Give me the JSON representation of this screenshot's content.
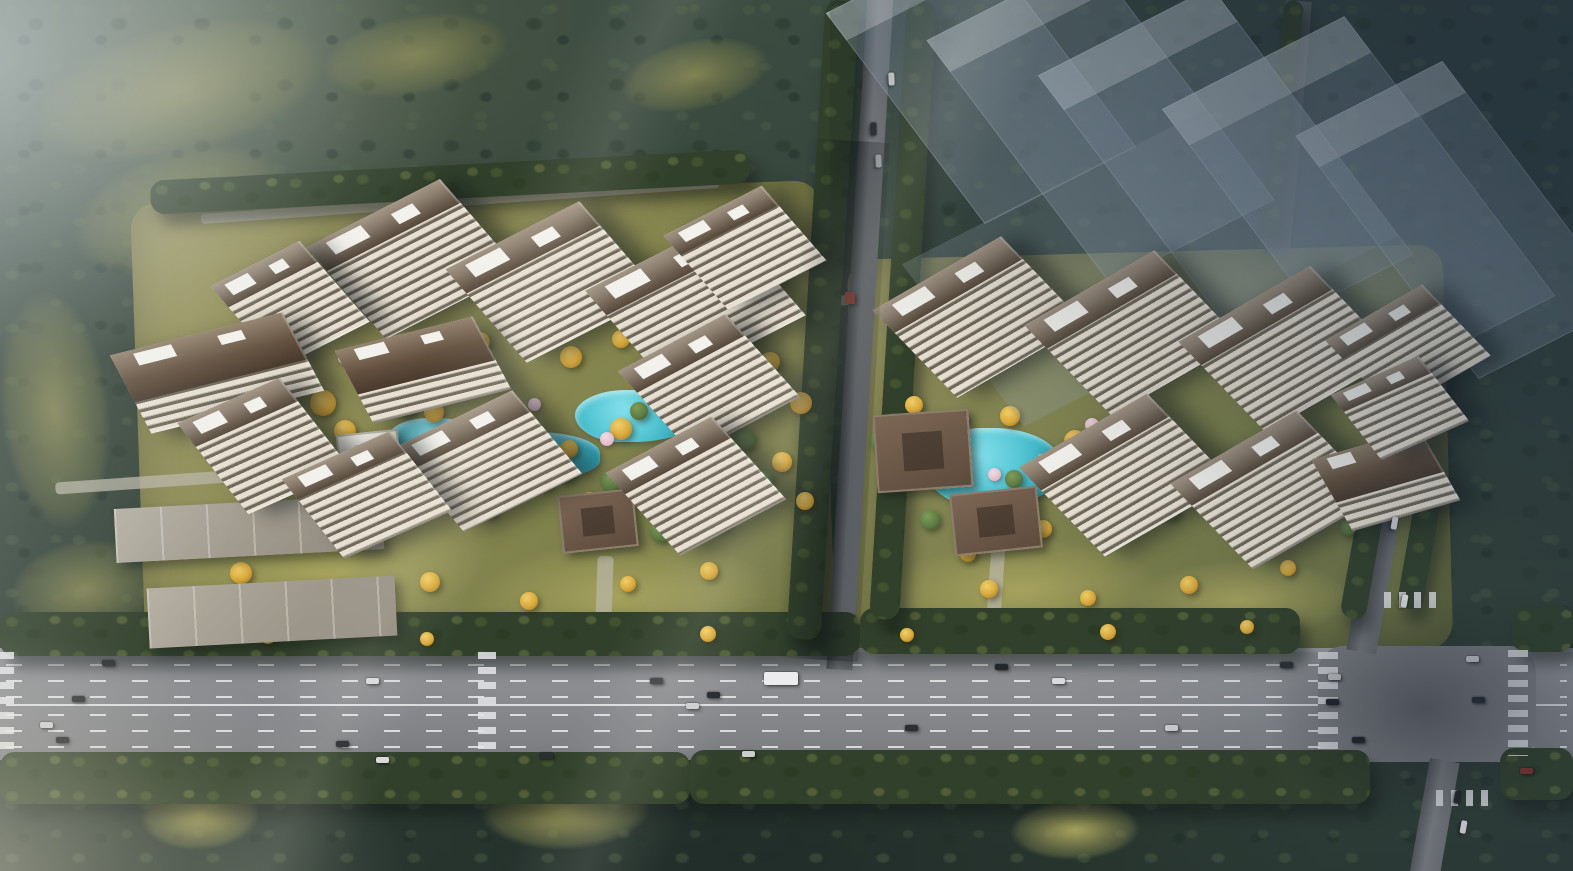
{
  "meta": {
    "scene_type": "aerial architectural rendering of a residential development",
    "width": 1573,
    "height": 871
  },
  "palette": {
    "field_olive": "#7d7f4f",
    "lawn_gold": "#a6a25d",
    "gold_tree": "#d9a93c",
    "green_tree": "#5d7a44",
    "blossom": "#e4becb",
    "pool": "#45bccd",
    "facade_light": "#e7e0d2",
    "facade_dark": "#6f685a",
    "roof_brown": "#64513f",
    "white_roof": "#f2f1ec"
  },
  "terrain": {
    "fields": [
      {
        "x": 30,
        "y": 25,
        "w": 300,
        "h": 130,
        "r": -14
      },
      {
        "x": 70,
        "y": 150,
        "w": 220,
        "h": 120,
        "r": -18
      },
      {
        "x": 320,
        "y": 15,
        "w": 190,
        "h": 80,
        "r": -10
      },
      {
        "x": 0,
        "y": 290,
        "w": 110,
        "h": 240,
        "r": -6
      },
      {
        "x": 10,
        "y": 540,
        "w": 150,
        "h": 100,
        "r": -8
      },
      {
        "x": 620,
        "y": 40,
        "w": 150,
        "h": 70,
        "r": -12
      }
    ],
    "lawns": [
      {
        "x": 180,
        "y": 520,
        "w": 300,
        "h": 110,
        "r": -4
      },
      {
        "x": 470,
        "y": 540,
        "w": 300,
        "h": 110,
        "r": -3
      },
      {
        "x": 880,
        "y": 540,
        "w": 280,
        "h": 100,
        "r": -3
      },
      {
        "x": 1130,
        "y": 560,
        "w": 220,
        "h": 80,
        "r": -2
      },
      {
        "x": 480,
        "y": 770,
        "w": 170,
        "h": 80,
        "r": -2
      },
      {
        "x": 140,
        "y": 780,
        "w": 120,
        "h": 70,
        "r": -3
      },
      {
        "x": 1010,
        "y": 800,
        "w": 130,
        "h": 60,
        "r": -2
      }
    ],
    "paths": [
      {
        "x": 55,
        "y": 470,
        "w": 360,
        "h": 12,
        "r": -4
      },
      {
        "x": 596,
        "y": 556,
        "w": 16,
        "h": 96,
        "r": 2
      },
      {
        "x": 988,
        "y": 545,
        "w": 14,
        "h": 100,
        "r": 4
      },
      {
        "x": 808,
        "y": 296,
        "w": 52,
        "h": 10,
        "r": -4
      },
      {
        "x": 200,
        "y": 196,
        "w": 520,
        "h": 10,
        "r": -4
      }
    ]
  },
  "vegetation": {
    "tree_rows": [
      {
        "x": 0,
        "y": 612,
        "w": 860,
        "h": 44,
        "r": 0
      },
      {
        "x": 860,
        "y": 608,
        "w": 440,
        "h": 46,
        "r": 0
      },
      {
        "x": 1512,
        "y": 606,
        "w": 61,
        "h": 46,
        "r": 0
      },
      {
        "x": 0,
        "y": 752,
        "w": 690,
        "h": 52,
        "r": 0
      },
      {
        "x": 690,
        "y": 750,
        "w": 680,
        "h": 54,
        "r": 0
      },
      {
        "x": 1500,
        "y": 748,
        "w": 73,
        "h": 52,
        "r": 0
      },
      {
        "x": 806,
        "y": 0,
        "w": 34,
        "h": 640,
        "r": 3.5
      },
      {
        "x": 888,
        "y": 0,
        "w": 30,
        "h": 620,
        "r": 3.5
      },
      {
        "x": 1352,
        "y": 470,
        "w": 26,
        "h": 150,
        "r": 10
      },
      {
        "x": 1408,
        "y": 470,
        "w": 26,
        "h": 140,
        "r": 10
      },
      {
        "x": 150,
        "y": 165,
        "w": 600,
        "h": 34,
        "r": -3
      },
      {
        "x": 1272,
        "y": 0,
        "w": 20,
        "h": 240,
        "r": 6
      }
    ],
    "golden_trees": [
      [
        310,
        390,
        26
      ],
      [
        334,
        420,
        22
      ],
      [
        368,
        455,
        24
      ],
      [
        298,
        470,
        20
      ],
      [
        424,
        402,
        20
      ],
      [
        450,
        418,
        18
      ],
      [
        505,
        452,
        24
      ],
      [
        534,
        470,
        20
      ],
      [
        560,
        440,
        18
      ],
      [
        610,
        418,
        22
      ],
      [
        640,
        450,
        26
      ],
      [
        680,
        430,
        20
      ],
      [
        700,
        462,
        24
      ],
      [
        722,
        408,
        18
      ],
      [
        660,
        482,
        22
      ],
      [
        580,
        492,
        20
      ],
      [
        480,
        500,
        18
      ],
      [
        410,
        492,
        16
      ],
      [
        350,
        498,
        18
      ],
      [
        470,
        332,
        20
      ],
      [
        560,
        346,
        22
      ],
      [
        612,
        330,
        18
      ],
      [
        760,
        352,
        20
      ],
      [
        790,
        392,
        22
      ],
      [
        772,
        452,
        20
      ],
      [
        796,
        492,
        18
      ],
      [
        230,
        562,
        22
      ],
      [
        300,
        586,
        18
      ],
      [
        420,
        572,
        20
      ],
      [
        520,
        592,
        18
      ],
      [
        620,
        576,
        16
      ],
      [
        700,
        562,
        18
      ],
      [
        905,
        396,
        18
      ],
      [
        1000,
        406,
        20
      ],
      [
        1064,
        430,
        22
      ],
      [
        1090,
        470,
        26
      ],
      [
        1114,
        500,
        22
      ],
      [
        1150,
        470,
        20
      ],
      [
        1180,
        440,
        18
      ],
      [
        1210,
        470,
        16
      ],
      [
        1240,
        500,
        18
      ],
      [
        1034,
        520,
        18
      ],
      [
        960,
        546,
        16
      ],
      [
        1264,
        430,
        16
      ],
      [
        980,
        580,
        18
      ],
      [
        1080,
        590,
        16
      ],
      [
        1180,
        576,
        18
      ],
      [
        1280,
        560,
        16
      ],
      [
        260,
        628,
        16
      ],
      [
        420,
        632,
        14
      ],
      [
        700,
        626,
        16
      ],
      [
        900,
        628,
        14
      ],
      [
        1100,
        624,
        16
      ],
      [
        1240,
        620,
        14
      ]
    ],
    "green_trees": [
      [
        395,
        395,
        22
      ],
      [
        440,
        440,
        20
      ],
      [
        475,
        470,
        18
      ],
      [
        520,
        420,
        16
      ],
      [
        555,
        462,
        20
      ],
      [
        600,
        470,
        22
      ],
      [
        630,
        402,
        18
      ],
      [
        700,
        390,
        16
      ],
      [
        735,
        430,
        20
      ],
      [
        755,
        470,
        18
      ],
      [
        870,
        430,
        22
      ],
      [
        920,
        510,
        20
      ],
      [
        1005,
        470,
        18
      ],
      [
        1060,
        440,
        16
      ],
      [
        1160,
        500,
        20
      ],
      [
        1230,
        450,
        18
      ],
      [
        260,
        430,
        20
      ],
      [
        280,
        500,
        18
      ],
      [
        650,
        520,
        22
      ],
      [
        710,
        510,
        20
      ],
      [
        1300,
        470,
        18
      ],
      [
        1340,
        520,
        16
      ]
    ],
    "blossom_trees": [
      [
        435,
        432,
        16
      ],
      [
        462,
        452,
        14
      ],
      [
        528,
        398,
        13
      ],
      [
        600,
        432,
        14
      ],
      [
        955,
        412,
        14
      ],
      [
        988,
        468,
        13
      ],
      [
        1085,
        418,
        14
      ],
      [
        1142,
        432,
        12
      ],
      [
        338,
        352,
        12
      ]
    ]
  },
  "water": {
    "ponds": [
      {
        "x": 388,
        "y": 418,
        "w": 95,
        "h": 42
      },
      {
        "x": 470,
        "y": 432,
        "w": 130,
        "h": 48
      },
      {
        "x": 575,
        "y": 390,
        "w": 120,
        "h": 52
      },
      {
        "x": 668,
        "y": 388,
        "w": 55,
        "h": 36
      },
      {
        "x": 425,
        "y": 466,
        "w": 60,
        "h": 26
      },
      {
        "x": 925,
        "y": 428,
        "w": 135,
        "h": 78
      },
      {
        "x": 1048,
        "y": 470,
        "w": 60,
        "h": 30
      },
      {
        "x": 1118,
        "y": 440,
        "w": 70,
        "h": 30
      }
    ]
  },
  "buildings": {
    "towers": [
      {
        "x": 338,
        "y": 200,
        "w": 150,
        "h": 118,
        "r": -27
      },
      {
        "x": 478,
        "y": 222,
        "w": 150,
        "h": 120,
        "r": -27
      },
      {
        "x": 618,
        "y": 242,
        "w": 155,
        "h": 122,
        "r": -27
      },
      {
        "x": 240,
        "y": 252,
        "w": 100,
        "h": 104,
        "r": -27
      },
      {
        "x": 128,
        "y": 330,
        "w": 178,
        "h": 86,
        "r": -14,
        "v": "low"
      },
      {
        "x": 208,
        "y": 390,
        "w": 112,
        "h": 112,
        "r": -24
      },
      {
        "x": 352,
        "y": 330,
        "w": 142,
        "h": 80,
        "r": -14,
        "v": "low"
      },
      {
        "x": 422,
        "y": 408,
        "w": 132,
        "h": 106,
        "r": -26
      },
      {
        "x": 308,
        "y": 446,
        "w": 118,
        "h": 98,
        "r": -24
      },
      {
        "x": 648,
        "y": 330,
        "w": 122,
        "h": 108,
        "r": -28
      },
      {
        "x": 636,
        "y": 432,
        "w": 120,
        "h": 108,
        "r": -28
      },
      {
        "x": 690,
        "y": 200,
        "w": 110,
        "h": 96,
        "r": -27
      },
      {
        "x": 905,
        "y": 258,
        "w": 148,
        "h": 118,
        "r": -30
      },
      {
        "x": 1058,
        "y": 272,
        "w": 150,
        "h": 122,
        "r": -30
      },
      {
        "x": 1212,
        "y": 288,
        "w": 152,
        "h": 122,
        "r": -30
      },
      {
        "x": 1352,
        "y": 300,
        "w": 112,
        "h": 96,
        "r": -30
      },
      {
        "x": 1052,
        "y": 415,
        "w": 148,
        "h": 120,
        "r": -30
      },
      {
        "x": 1202,
        "y": 432,
        "w": 146,
        "h": 116,
        "r": -30
      },
      {
        "x": 1330,
        "y": 440,
        "w": 112,
        "h": 80,
        "r": -16,
        "v": "low"
      },
      {
        "x": 1352,
        "y": 368,
        "w": 96,
        "h": 80,
        "r": -24
      }
    ],
    "warehouses": [
      {
        "x": 115,
        "y": 502,
        "w": 268,
        "h": 54,
        "r": -3
      },
      {
        "x": 148,
        "y": 582,
        "w": 248,
        "h": 60,
        "r": -3
      }
    ],
    "pavilions": [
      {
        "x": 402,
        "y": 346,
        "w": 48,
        "h": 38,
        "r": -8,
        "v": "white"
      },
      {
        "x": 560,
        "y": 492,
        "w": 72,
        "h": 54,
        "r": -6
      },
      {
        "x": 875,
        "y": 412,
        "w": 92,
        "h": 74,
        "r": -4
      },
      {
        "x": 952,
        "y": 490,
        "w": 84,
        "h": 58,
        "r": -6
      },
      {
        "x": 338,
        "y": 432,
        "w": 58,
        "h": 42,
        "r": -6,
        "v": "white"
      },
      {
        "x": 1040,
        "y": 452,
        "w": 40,
        "h": 30,
        "r": -6,
        "v": "white"
      },
      {
        "x": 845,
        "y": 292,
        "w": 10,
        "h": 12,
        "r": 0,
        "v": "red"
      }
    ],
    "ghost_blocks": [
      {
        "x": 896,
        "y": -50,
        "w": 170,
        "h": 260,
        "r": -27
      },
      {
        "x": 1008,
        "y": -30,
        "w": 185,
        "h": 300,
        "r": -27
      },
      {
        "x": 1128,
        "y": 0,
        "w": 195,
        "h": 330,
        "r": -27
      },
      {
        "x": 1256,
        "y": 30,
        "w": 205,
        "h": 345,
        "r": -27
      },
      {
        "x": 1378,
        "y": 70,
        "w": 165,
        "h": 300,
        "r": -27
      },
      {
        "x": 940,
        "y": 150,
        "w": 420,
        "h": 200,
        "r": -27,
        "v": "podium"
      }
    ]
  },
  "roads": {
    "lane_lines": [
      [
        16,
        "dash"
      ],
      [
        32,
        "dash"
      ],
      [
        48,
        "dash"
      ],
      [
        56,
        "solid"
      ],
      [
        66,
        "dash"
      ],
      [
        82,
        "dash"
      ],
      [
        98,
        "dash"
      ]
    ],
    "crosswalks": [
      [
        1318,
        652,
        20,
        104,
        "v"
      ],
      [
        1508,
        650,
        20,
        106,
        "v"
      ],
      [
        1384,
        592,
        56,
        16,
        "h"
      ],
      [
        1436,
        790,
        56,
        16,
        "h"
      ],
      [
        478,
        652,
        18,
        104,
        "v"
      ],
      [
        0,
        652,
        14,
        104,
        "v"
      ]
    ],
    "cars": [
      [
        102,
        660,
        0,
        "#2b2e33"
      ],
      [
        366,
        678,
        0,
        "#d9dadc"
      ],
      [
        650,
        678,
        0,
        "#3a3e44"
      ],
      [
        707,
        692,
        0,
        "#23262b"
      ],
      [
        686,
        703,
        0,
        "#cbcdcf"
      ],
      [
        72,
        696,
        0,
        "#2b2e33"
      ],
      [
        40,
        722,
        0,
        "#cbcdcf"
      ],
      [
        56,
        737,
        0,
        "#23262b"
      ],
      [
        336,
        741,
        0,
        "#23262b"
      ],
      [
        376,
        757,
        0,
        "#d9dadc"
      ],
      [
        540,
        753,
        0,
        "#2b2e33"
      ],
      [
        742,
        751,
        0,
        "#cbcdcf"
      ],
      [
        764,
        672,
        0,
        "#ececee",
        34,
        13
      ],
      [
        995,
        664,
        0,
        "#23262b"
      ],
      [
        1052,
        678,
        0,
        "#d9dadc"
      ],
      [
        1280,
        662,
        0,
        "#2b2e33"
      ],
      [
        1328,
        674,
        0,
        "#cbcdcf"
      ],
      [
        1326,
        699,
        0,
        "#23262b"
      ],
      [
        1466,
        656,
        0,
        "#d9dadc"
      ],
      [
        1472,
        697,
        0,
        "#2b2e33"
      ],
      [
        1352,
        737,
        0,
        "#23262b"
      ],
      [
        1165,
        725,
        0,
        "#cbcdcf"
      ],
      [
        905,
        725,
        0,
        "#2b2e33"
      ],
      [
        1520,
        768,
        0,
        "#7e332c"
      ],
      [
        885,
        76,
        88,
        "#d9dadc"
      ],
      [
        867,
        126,
        88,
        "#2b2e33"
      ],
      [
        872,
        158,
        88,
        "#cbcdcf"
      ],
      [
        1398,
        598,
        100,
        "#e4e5e7"
      ],
      [
        1388,
        520,
        100,
        "#cbcdcf"
      ],
      [
        1451,
        794,
        100,
        "#23262b"
      ],
      [
        1457,
        824,
        100,
        "#d9dadc"
      ]
    ]
  }
}
